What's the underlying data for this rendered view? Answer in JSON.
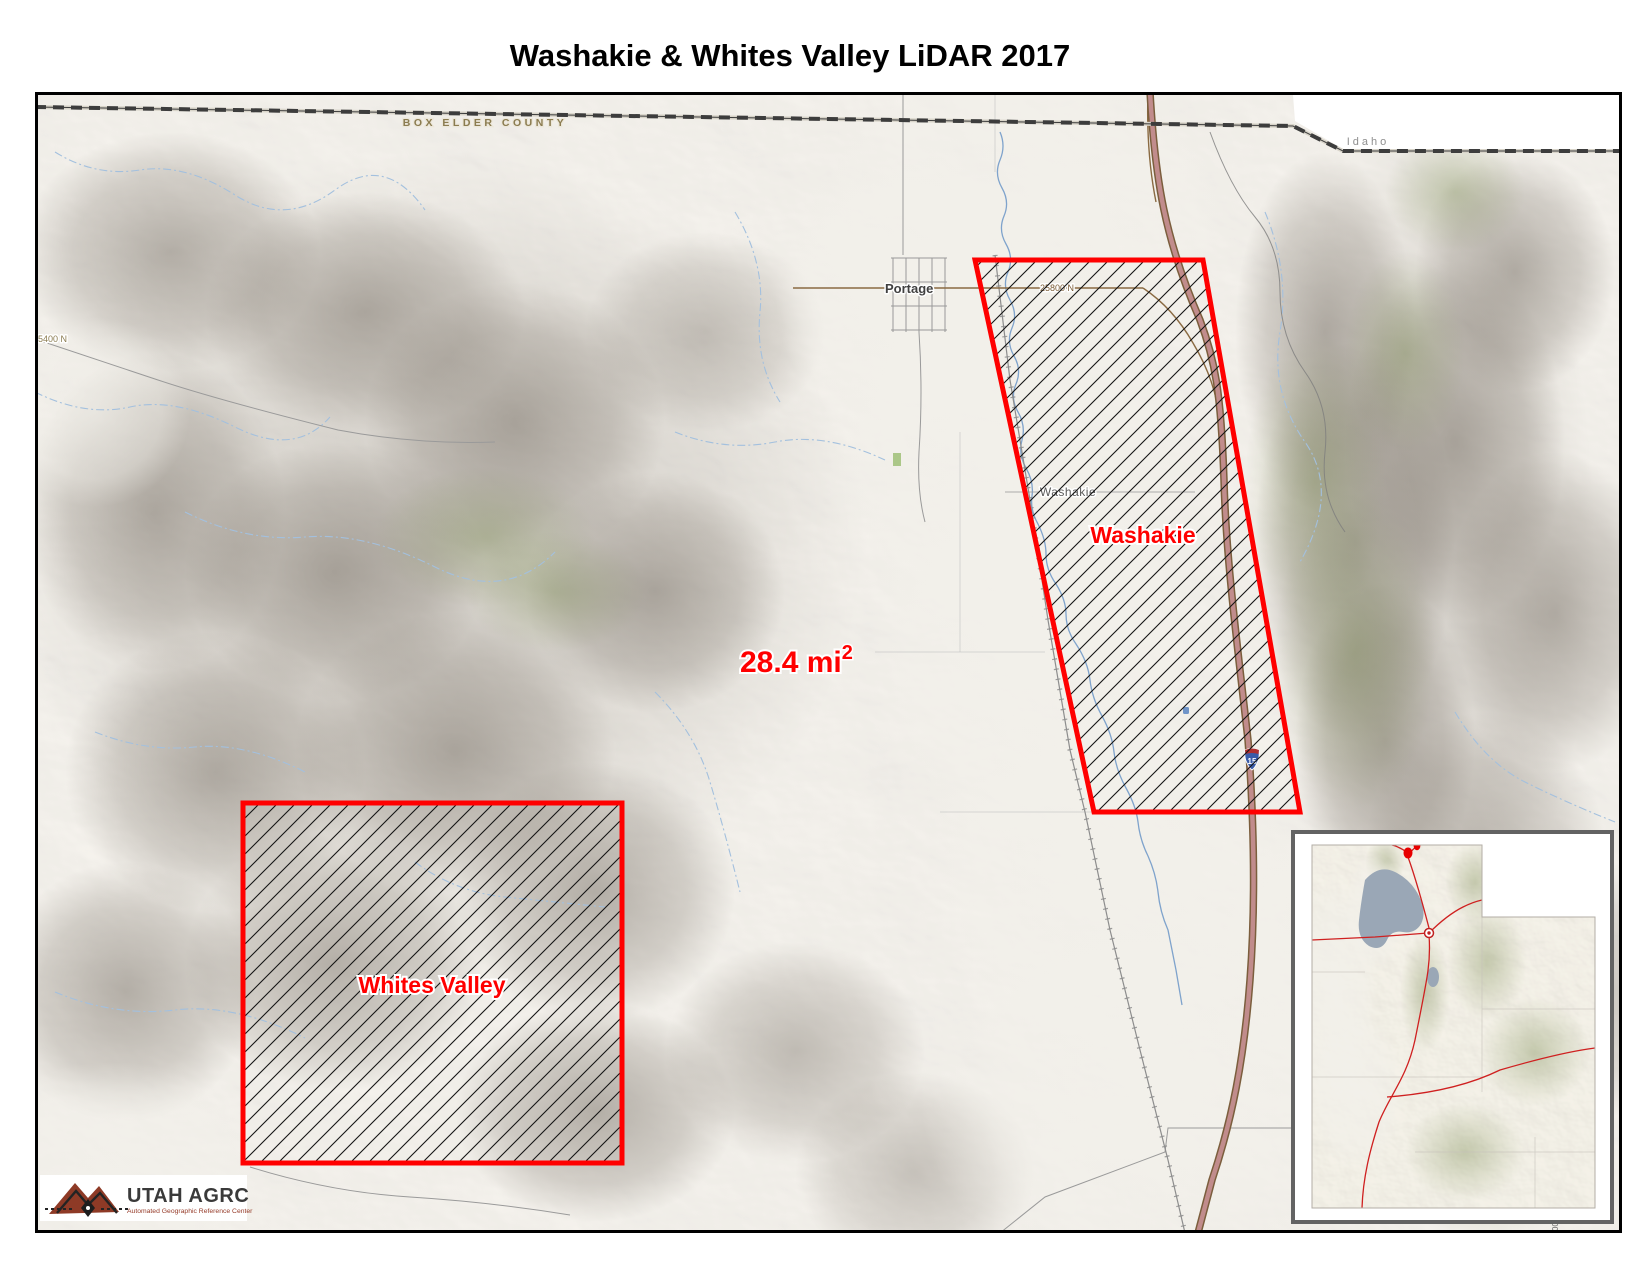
{
  "title": "Washakie & Whites Valley LiDAR 2017",
  "map": {
    "county_label": "BOX ELDER COUNTY",
    "state_label": "Idaho",
    "town_label": "Portage",
    "place_label": "Washakie",
    "road_labels": {
      "main": "25800 N",
      "west": "5400 N",
      "partial": "00"
    },
    "highway_shield": "15",
    "areas": {
      "washakie": {
        "label": "Washakie"
      },
      "whites_valley": {
        "label": "Whites Valley"
      },
      "total": {
        "value": "28.4 mi",
        "superscript": "2"
      }
    }
  },
  "logo": {
    "name": "UTAH AGRC",
    "tagline": "Automated Geographic Reference Center"
  },
  "colors": {
    "area_outline": "#ff0000",
    "area_label": "#ff0000",
    "highway_fill": "#c18c8c",
    "water": "#9fbcdc",
    "county_text": "#8b7c50"
  }
}
